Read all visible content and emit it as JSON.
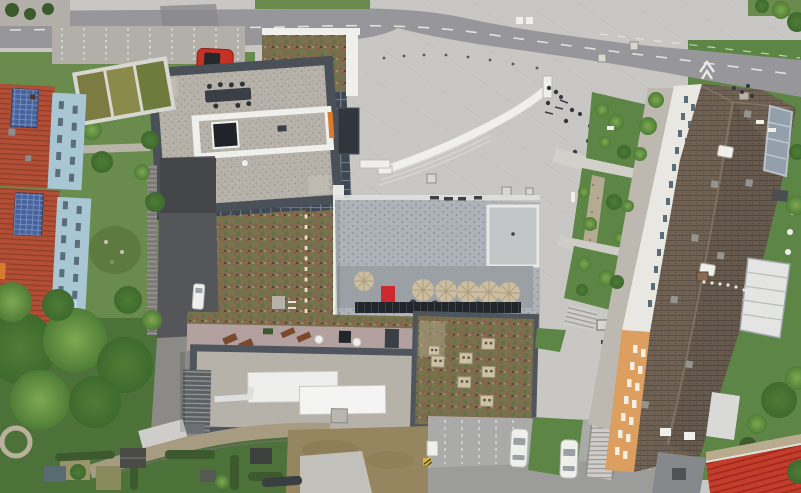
{
  "scene": {
    "type": "aerial-drone-photograph",
    "description": "Top-down aerial view of an urban building complex: a tower with gravel roof and roof terrace, green sedum roofs, a large paved plaza with an S-curved bench, cafe terrace with parasols and a solar panel row, a long tiled-roof residential block with white and orange facades, red tiled houses with solar panels, roads, parking bays with white cars, gardens, allotments and trees.",
    "visible_text": []
  },
  "inventory": {
    "red_cars": 1,
    "white_parked_cars": 2,
    "white_van_on_ramp": 1,
    "terrace_parasols": 6,
    "roof_lounge_chairs": 4,
    "sedum_roof_vents": 7,
    "pedestrians_approx": 16,
    "raised_planter_beds": 3
  },
  "palette": {
    "road": "#97979b",
    "road_dark": "#87878c",
    "sidewalk": "#b2afa9",
    "plaza": "#c8c7c3",
    "plaza_streak": "#bfbeba",
    "lane_white": "#e9e9e7",
    "grass": "#6a8b4e",
    "lawn": "#5d8545",
    "grass_shadow": "#4c7239",
    "tree_dark": "#3e6a2d",
    "tree_mid": "#4e7d36",
    "tree_light": "#7fa851",
    "hedge": "#3c5a2e",
    "creek": "#b5aa92",
    "pebble": "#8d8570",
    "red_car": "#c53125",
    "car_glass": "#9aa0a4",
    "white": "#efefec",
    "bench_step": "#d8d7d2",
    "red_roof": "#b14e35",
    "red_roof_line": "#8f3d28",
    "solar_blue": "#46639c",
    "solar_line": "#7e95c4",
    "facade_blue": "#a9c6d5",
    "window_dark": "#5a6e7a",
    "planter_frame": "#d9d7d1",
    "planter_green": "#7c7c42",
    "bin_blue": "#3a6ab0",
    "tower_parapet": "#4a5057",
    "gravel": "#b6b2aa",
    "gravel_dot1": "#a29d92",
    "gravel_dot2": "#8f8a80",
    "skylight": "#202329",
    "facade_grid": "#3f4752",
    "facade_grid_line": "#727c88",
    "orange_accent": "#d97b2e",
    "sedum_base": "#7c6e50",
    "sedum_green": "#6c7c44",
    "sedum_green2": "#5f7340",
    "sedum_rust": "#8f5c3e",
    "sedum_dark": "#4f4632",
    "sedum_light": "#a39a78",
    "path_dash": "#e6e1c9",
    "slate": "#adb3b8",
    "slate_dot": "#8f969c",
    "slate_light": "#c3c6c7",
    "terrace": "#9aa0a3",
    "umbrella": "#cbbda0",
    "umbrella_line": "#ab9d7e",
    "table_dark": "#383d42",
    "red_accent": "#cc2a2e",
    "solar_dark": "#22262b",
    "mauve": "#b2a19f",
    "lounger": "#7a4a2e",
    "parapet_dark": "#4f555c",
    "hvac": "#eeefed",
    "vent_beige": "#cec2a5",
    "vent_dot": "#5a5246",
    "asphalt": "#aaaaa8",
    "asphalt_dark": "#969694",
    "dirt": "#95865f",
    "dirt_dark": "#8a7a52",
    "concrete": "#c2c0ba",
    "brown_roof": "#6f6154",
    "brown_line": "#5a4d42",
    "ridge": "#8d7d6c",
    "facade_white": "#e9e7e2",
    "facade_orange": "#dd9f60",
    "orange_window": "#f5efe3",
    "balcony": "#93a0ab",
    "balcony_line": "#c6cdd3",
    "annex_white": "#e4e5e3",
    "annex_gray": "#86898c",
    "red_bright": "#c23d2b",
    "red_corr": "#a1281a",
    "tan_strip": "#b9ab8e",
    "wall": "#7b7a76",
    "step_line": "#9b9995",
    "ramp": "#55565a",
    "ramp_dark": "#434549",
    "person": "#34383c",
    "white_arrow": "#eceae4",
    "stair_light": "#cfcdc9",
    "shed_dark": "#4a4a46",
    "shed_blue": "#5a6a72",
    "plot_tan": "#9a9468",
    "equip_yellow": "#d4b63c"
  }
}
